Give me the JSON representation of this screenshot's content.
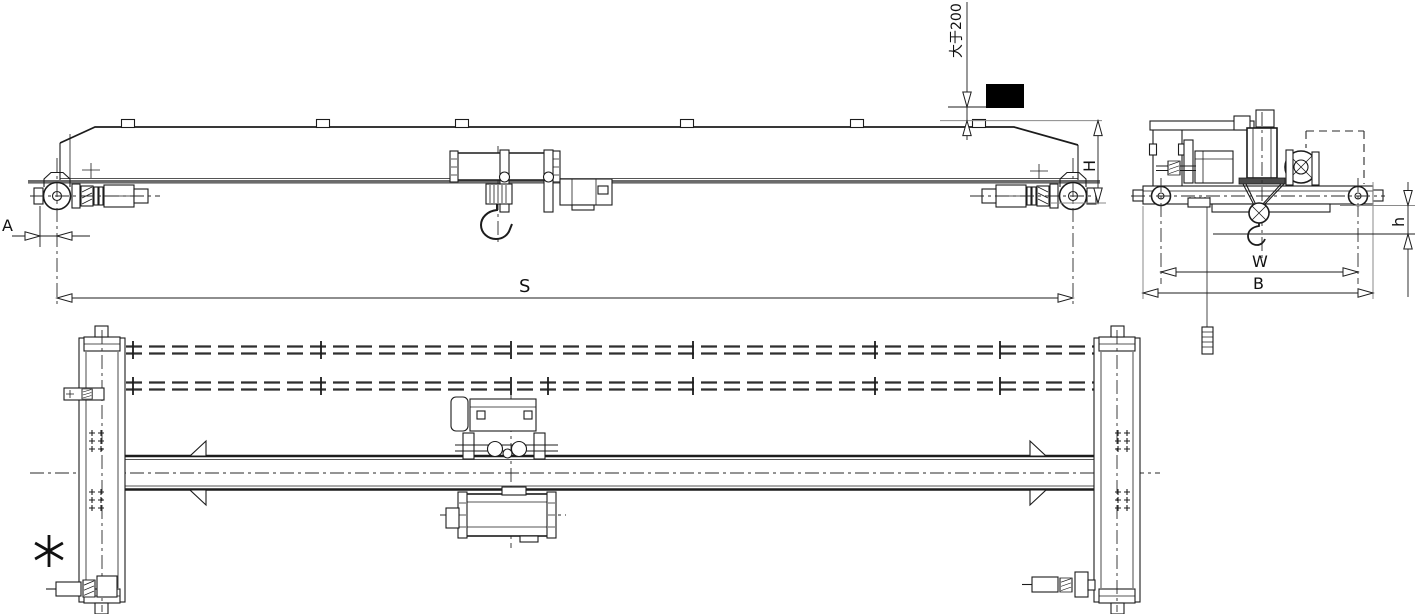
{
  "drawing": {
    "labels": {
      "clearance_note": "大于200",
      "dim_A": "A",
      "dim_S": "S",
      "dim_H": "H",
      "dim_h": "h",
      "dim_W": "W",
      "dim_B": "B",
      "footnote_marker": "✳"
    },
    "colors": {
      "line": "#1c1c1c",
      "heavy_line": "#6b6b6b",
      "solid_fill": "#000000",
      "background": "#ffffff"
    }
  }
}
